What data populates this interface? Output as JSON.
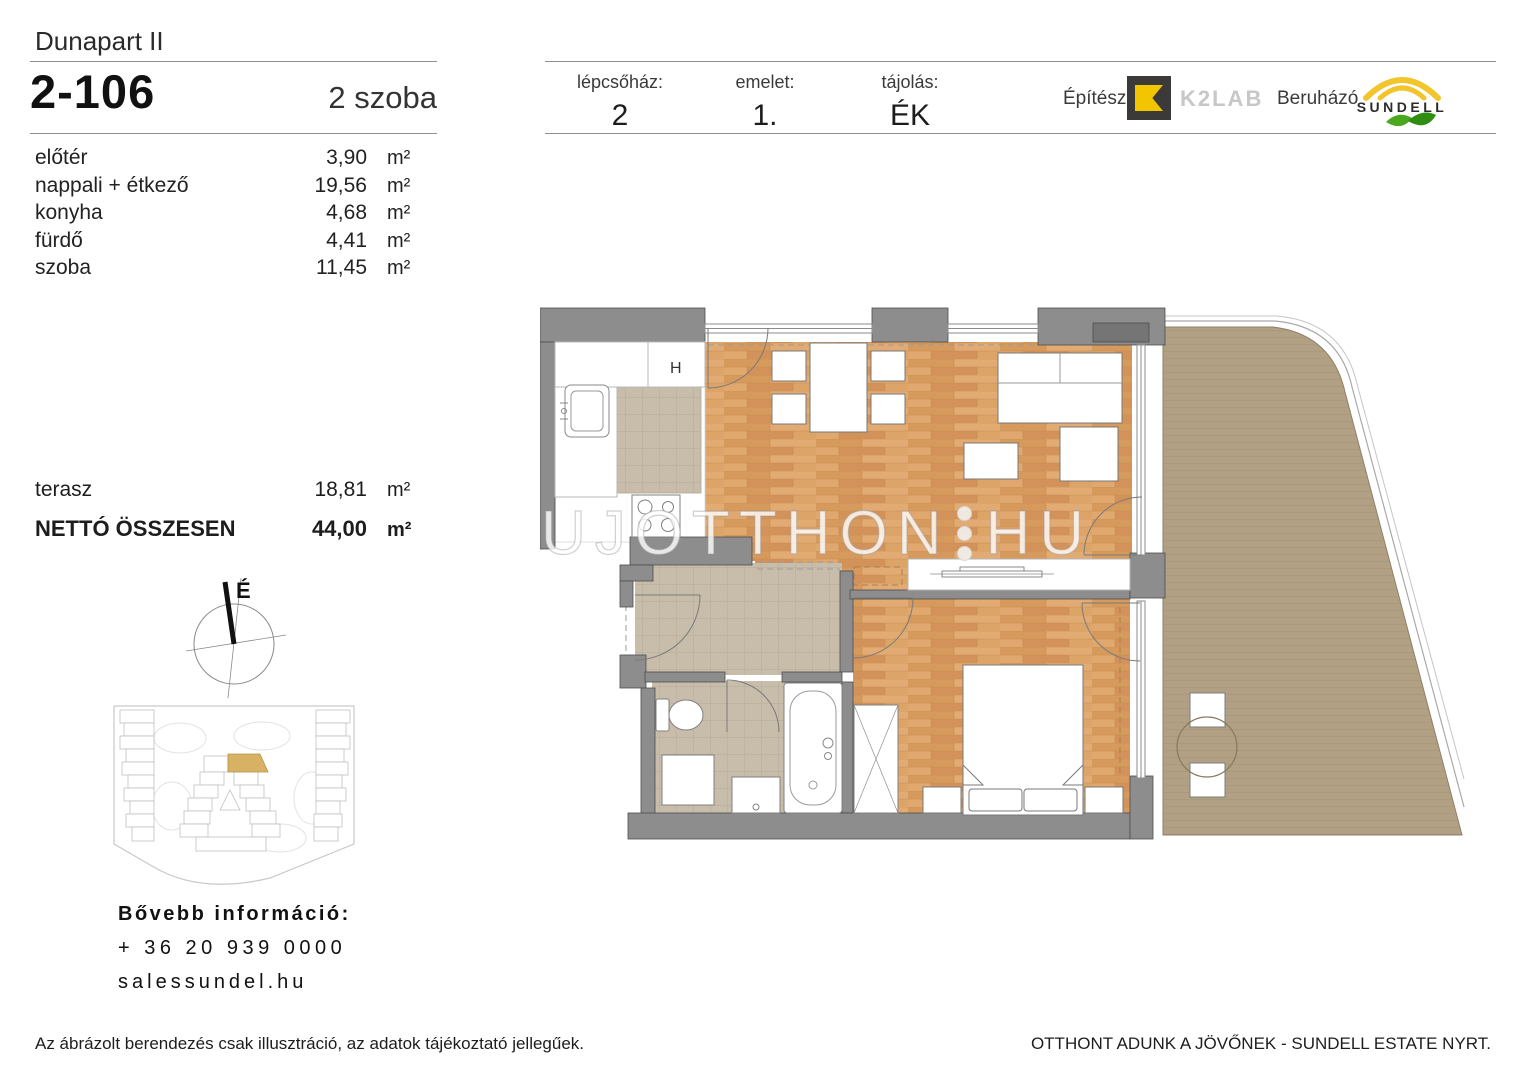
{
  "page": {
    "project": "Dunapart II",
    "unit_id": "2-106",
    "unit_type": "2 szoba"
  },
  "rooms": [
    {
      "name": "előtér",
      "area": "3,90",
      "unit": "m²"
    },
    {
      "name": "nappali + étkező",
      "area": "19,56",
      "unit": "m²"
    },
    {
      "name": "konyha",
      "area": "4,68",
      "unit": "m²"
    },
    {
      "name": "fürdő",
      "area": "4,41",
      "unit": "m²"
    },
    {
      "name": "szoba",
      "area": "11,45",
      "unit": "m²"
    }
  ],
  "terrace": {
    "name": "terasz",
    "area": "18,81",
    "unit": "m²"
  },
  "total": {
    "name": "NETTÓ ÖSSZESEN",
    "area": "44,00",
    "unit": "m²"
  },
  "info": {
    "staircase_label": "lépcsőház:",
    "staircase_value": "2",
    "floor_label": "emelet:",
    "floor_value": "1.",
    "orientation_label": "tájolás:",
    "orientation_value": "ÉK"
  },
  "branding": {
    "architect_label": "Építész",
    "architect_name": "K2LAB",
    "developer_label": "Beruházó",
    "developer_name": "SUNDELL"
  },
  "compass": {
    "north_label": "É"
  },
  "floorplan": {
    "fridge_label": "H"
  },
  "watermark": {
    "part1": "UJOTTHON",
    "part2": "HU"
  },
  "contact": {
    "heading": "Bővebb információ:",
    "phone": "+ 36 20 939 0000",
    "website": "salessundel.hu"
  },
  "footer": {
    "disclaimer": "Az ábrázolt berendezés csak illusztráció, az adatok tájékoztató jellegűek.",
    "slogan": "OTTHONT ADUNK A JÖVŐNEK - SUNDELL ESTATE NYRT."
  },
  "colors": {
    "k2lab_yellow": "#f2c500",
    "k2lab_dark": "#3b3a38",
    "sundell_yellow": "#f3c52c",
    "leaf_green_light": "#4aa81e",
    "leaf_green_dark": "#2f8d12",
    "unit_highlight_tan": "#d8b264",
    "wood_floor": "#dba269",
    "terrace_deck": "#b1a083",
    "tile_floor": "#c8bdaa",
    "wall_gray": "#8d8d8d"
  }
}
